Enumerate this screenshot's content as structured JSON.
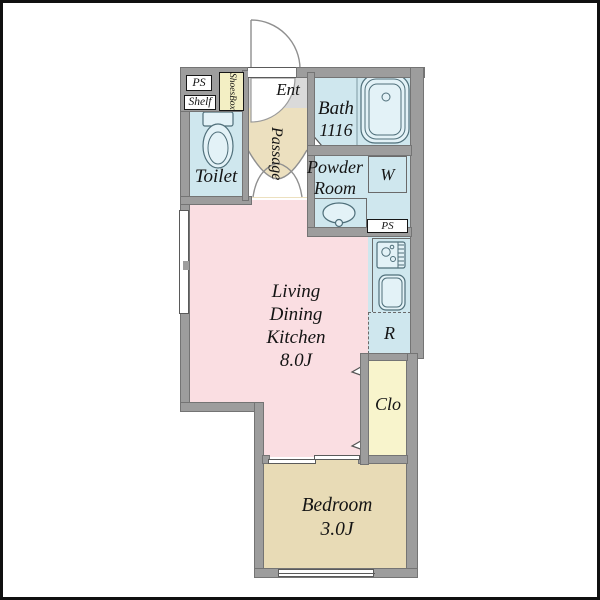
{
  "plan_title": "apartment-floor-plan",
  "rooms": {
    "toilet": "Toilet",
    "ent": "Ent",
    "passage": "Passage",
    "bath_name": "Bath",
    "bath_size": "1116",
    "powder_line1": "Powder",
    "powder_line2": "Room",
    "washer": "W",
    "fridge": "R",
    "closet": "Clo",
    "ldk_line1": "Living",
    "ldk_line2": "Dining",
    "ldk_line3": "Kitchen",
    "ldk_size": "8.0J",
    "bedroom_name": "Bedroom",
    "bedroom_size": "3.0J"
  },
  "fixtures": {
    "ps_upper": "PS",
    "ps_kitchen": "PS",
    "shelf": "Shelf",
    "shoes_line1": "Shoes",
    "shoes_line2": "Box"
  },
  "colors": {
    "wall": "#9d9d9d",
    "wet": "#cfe7ee",
    "fixture": "#e3f2f7",
    "ldk": "#fadee2",
    "bedroom": "#e8dbb6",
    "closet": "#f8f4cc",
    "passage": "#ece0bf",
    "shoes": "#f3efc4",
    "ent": "#dadada",
    "text": "#141414"
  }
}
